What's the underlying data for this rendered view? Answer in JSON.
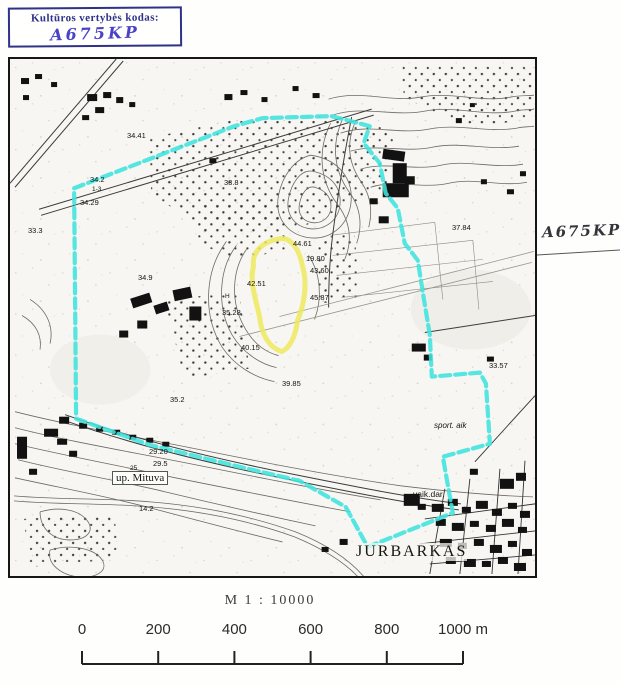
{
  "stamp": {
    "label": "Kultūros vertybės kodas:",
    "code": "A675KP"
  },
  "side_annotation": {
    "code": "A675KP"
  },
  "map": {
    "labels": [
      {
        "text": "34.41",
        "x": 127,
        "y": 131,
        "cls": "elev"
      },
      {
        "text": "34.2",
        "x": 90,
        "y": 175,
        "cls": "elev"
      },
      {
        "text": "1-3",
        "x": 92,
        "y": 186,
        "cls": "tiny"
      },
      {
        "text": "34.29",
        "x": 80,
        "y": 198,
        "cls": "elev"
      },
      {
        "text": "33.3",
        "x": 28,
        "y": 226,
        "cls": "elev"
      },
      {
        "text": "33.8",
        "x": 224,
        "y": 178,
        "cls": "elev"
      },
      {
        "text": "34.9",
        "x": 138,
        "y": 273,
        "cls": "elev"
      },
      {
        "text": "35.28",
        "x": 222,
        "y": 308,
        "cls": "elev"
      },
      {
        "text": "H",
        "x": 225,
        "y": 293,
        "cls": "tiny"
      },
      {
        "text": "44.61",
        "x": 293,
        "y": 239,
        "cls": "elev"
      },
      {
        "text": "19.80",
        "x": 306,
        "y": 254,
        "cls": "elev"
      },
      {
        "text": "43.60",
        "x": 310,
        "y": 266,
        "cls": "elev"
      },
      {
        "text": "42.51",
        "x": 247,
        "y": 279,
        "cls": "elev"
      },
      {
        "text": "45.87",
        "x": 310,
        "y": 293,
        "cls": "elev"
      },
      {
        "text": "40.15",
        "x": 241,
        "y": 343,
        "cls": "elev"
      },
      {
        "text": "39.85",
        "x": 282,
        "y": 379,
        "cls": "elev"
      },
      {
        "text": "37.84",
        "x": 452,
        "y": 223,
        "cls": "elev"
      },
      {
        "text": "33.57",
        "x": 489,
        "y": 361,
        "cls": "elev"
      },
      {
        "text": "35.2",
        "x": 170,
        "y": 395,
        "cls": "elev"
      },
      {
        "text": "29.20",
        "x": 149,
        "y": 447,
        "cls": "elev"
      },
      {
        "text": "29.5",
        "x": 153,
        "y": 459,
        "cls": "elev"
      },
      {
        "text": "25",
        "x": 130,
        "y": 465,
        "cls": "tiny"
      },
      {
        "text": "14.2",
        "x": 139,
        "y": 504,
        "cls": "elev"
      },
      {
        "text": "sport. aik",
        "x": 434,
        "y": 421,
        "cls": "ital"
      },
      {
        "text": "vaik.dar.",
        "x": 413,
        "y": 489,
        "cls": "place"
      },
      {
        "text": "up. Mituva",
        "x": 112,
        "y": 471,
        "cls": "river"
      },
      {
        "text": "JURBARKAS",
        "x": 356,
        "y": 543,
        "cls": "city"
      }
    ]
  },
  "scale": {
    "title": "M 1 : 10000",
    "tick_labels": [
      "0",
      "200",
      "400",
      "600",
      "800",
      "1000 m"
    ]
  },
  "colors": {
    "boundary_cyan": "#3fe4de",
    "highlight_yellow": "#efe95f",
    "stamp_ink": "#2f3288",
    "handwriting_ink": "#4a43c8"
  }
}
